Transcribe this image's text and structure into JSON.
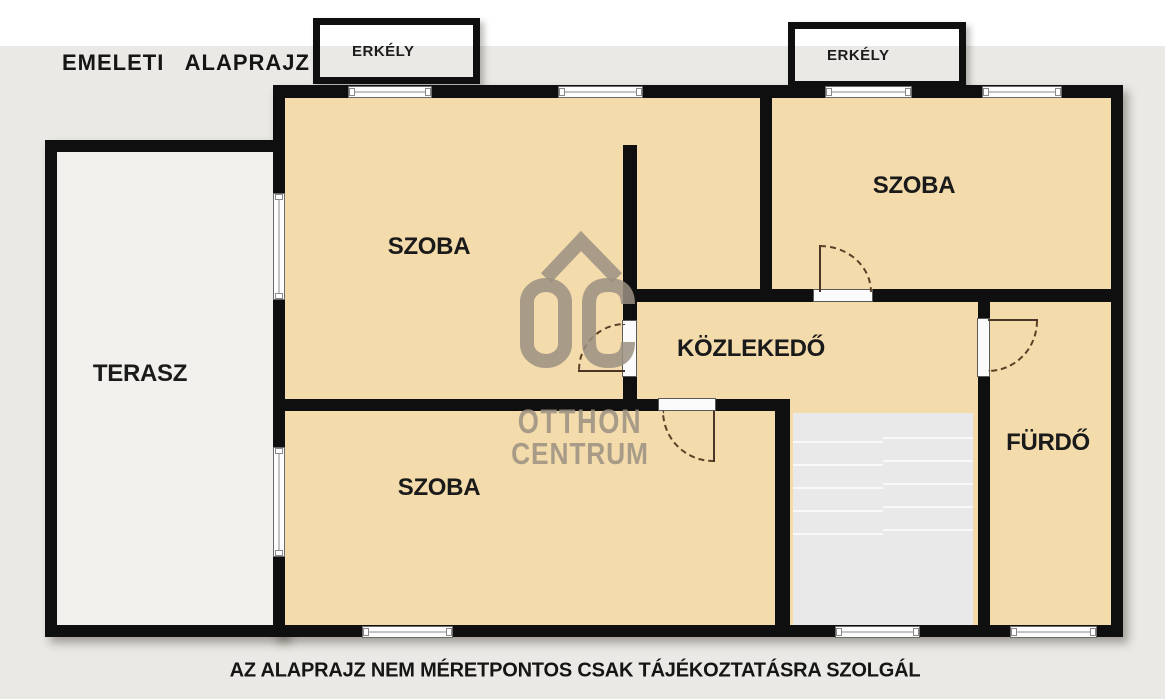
{
  "title": "EMELETI ALAPRAJZ",
  "disclaimer": "AZ ALAPRAJZ NEM MÉRETPONTOS CSAK TÁJÉKOZTATÁSRA SZOLGÁL",
  "balconies": [
    {
      "label": "ERKÉLY"
    },
    {
      "label": "ERKÉLY"
    }
  ],
  "rooms": {
    "szoba_top_left": {
      "label": "SZOBA"
    },
    "szoba_top_right": {
      "label": "SZOBA"
    },
    "szoba_bottom": {
      "label": "SZOBA"
    },
    "terasz": {
      "label": "TERASZ"
    },
    "kozlekedo": {
      "label": "KÖZLEKEDŐ"
    },
    "furdo": {
      "label": "FÜRDŐ"
    }
  },
  "watermark": {
    "logo": "OC",
    "line1": "OTTHON",
    "line2": "CENTRUM"
  },
  "colors": {
    "room_fill": "#f3dbab",
    "wall": "#0f0f0f",
    "background": "#ebe9e5",
    "terrace_fill": "#f2f0ec",
    "stairs_fill": "#e9e9e9",
    "watermark_gray": "#9b9181"
  }
}
